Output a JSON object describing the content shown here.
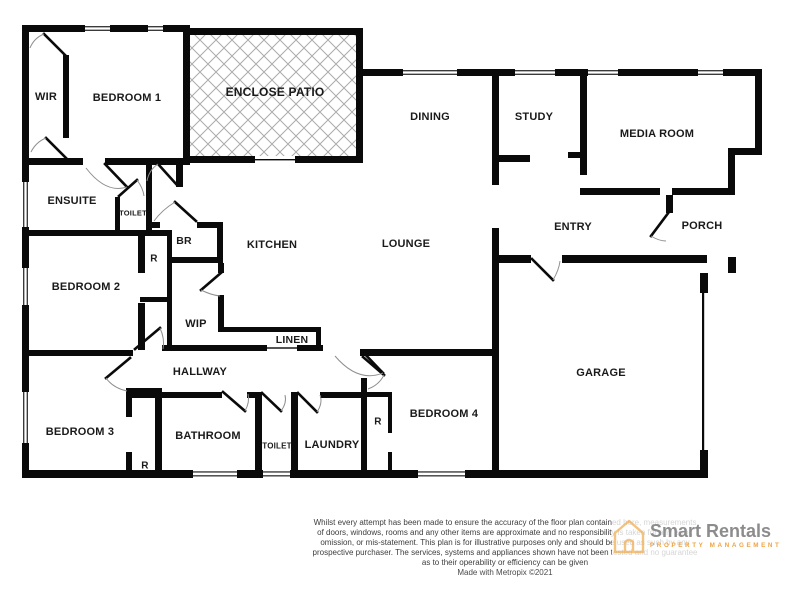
{
  "floorplan": {
    "rooms": [
      {
        "id": "wir",
        "label": "WIR",
        "x": 46,
        "y": 97,
        "fs": 11
      },
      {
        "id": "bedroom-1",
        "label": "BEDROOM 1",
        "x": 127,
        "y": 98,
        "fs": 11
      },
      {
        "id": "enclose-patio",
        "label": "ENCLOSE PATIO",
        "x": 275,
        "y": 92,
        "fs": 12
      },
      {
        "id": "dining",
        "label": "DINING",
        "x": 430,
        "y": 117,
        "fs": 11
      },
      {
        "id": "study",
        "label": "STUDY",
        "x": 534,
        "y": 117,
        "fs": 11
      },
      {
        "id": "media-room",
        "label": "MEDIA ROOM",
        "x": 657,
        "y": 134,
        "fs": 11
      },
      {
        "id": "ensuite",
        "label": "ENSUITE",
        "x": 72,
        "y": 201,
        "fs": 11
      },
      {
        "id": "toilet-ensuite",
        "label": "TOILET",
        "x": 133,
        "y": 213,
        "fs": 7.5
      },
      {
        "id": "br",
        "label": "BR",
        "x": 184,
        "y": 241,
        "fs": 10.5
      },
      {
        "id": "robe-bed2",
        "label": "R",
        "x": 154,
        "y": 259,
        "fs": 10
      },
      {
        "id": "kitchen",
        "label": "KITCHEN",
        "x": 272,
        "y": 245,
        "fs": 11
      },
      {
        "id": "bedroom-2",
        "label": "BEDROOM 2",
        "x": 86,
        "y": 287,
        "fs": 11
      },
      {
        "id": "lounge",
        "label": "LOUNGE",
        "x": 406,
        "y": 244,
        "fs": 11
      },
      {
        "id": "entry",
        "label": "ENTRY",
        "x": 573,
        "y": 227,
        "fs": 11
      },
      {
        "id": "porch",
        "label": "PORCH",
        "x": 702,
        "y": 226,
        "fs": 11
      },
      {
        "id": "wip",
        "label": "WIP",
        "x": 196,
        "y": 324,
        "fs": 11
      },
      {
        "id": "linen",
        "label": "LINEN",
        "x": 292,
        "y": 340,
        "fs": 10.5
      },
      {
        "id": "hallway",
        "label": "HALLWAY",
        "x": 200,
        "y": 372,
        "fs": 11
      },
      {
        "id": "garage",
        "label": "GARAGE",
        "x": 601,
        "y": 373,
        "fs": 11
      },
      {
        "id": "bedroom-3",
        "label": "BEDROOM 3",
        "x": 80,
        "y": 432,
        "fs": 11
      },
      {
        "id": "robe-bed3",
        "label": "R",
        "x": 145,
        "y": 466,
        "fs": 10
      },
      {
        "id": "bathroom",
        "label": "BATHROOM",
        "x": 208,
        "y": 436,
        "fs": 11
      },
      {
        "id": "toilet-main",
        "label": "TOILET",
        "x": 277,
        "y": 446,
        "fs": 8
      },
      {
        "id": "laundry",
        "label": "LAUNDRY",
        "x": 332,
        "y": 445,
        "fs": 11
      },
      {
        "id": "robe-bed4",
        "label": "R",
        "x": 378,
        "y": 422,
        "fs": 10
      },
      {
        "id": "bedroom-4",
        "label": "BEDROOM 4",
        "x": 444,
        "y": 414,
        "fs": 11
      }
    ]
  },
  "disclaimer": {
    "line1": "Whilst every attempt has been made to ensure the accuracy of the floor plan contained here, measurements",
    "line2": "of doors, windows, rooms and any other items are approximate and no responsibility is taken for any error,",
    "line3": "omission, or mis-statement. This plan is for illustrative purposes only and should be used as such by any",
    "line4": "prospective purchaser. The services, systems and appliances shown have not been tested and no guarantee",
    "line5": "as to their operability or efficiency can be given",
    "credit": "Made with Metropix ©2021"
  },
  "logo": {
    "brand": "Smart Rentals",
    "tagline": "PROPERTY MANAGEMENT"
  },
  "colors": {
    "wall": "#0a0a0a",
    "hatch": "#ababab",
    "door_arc": "#8f8f8f",
    "text": "#1a1a1a",
    "disclaimer_text": "#3d3d3d",
    "logo_gray": "#8c8c8c",
    "logo_orange": "#f0a340"
  }
}
